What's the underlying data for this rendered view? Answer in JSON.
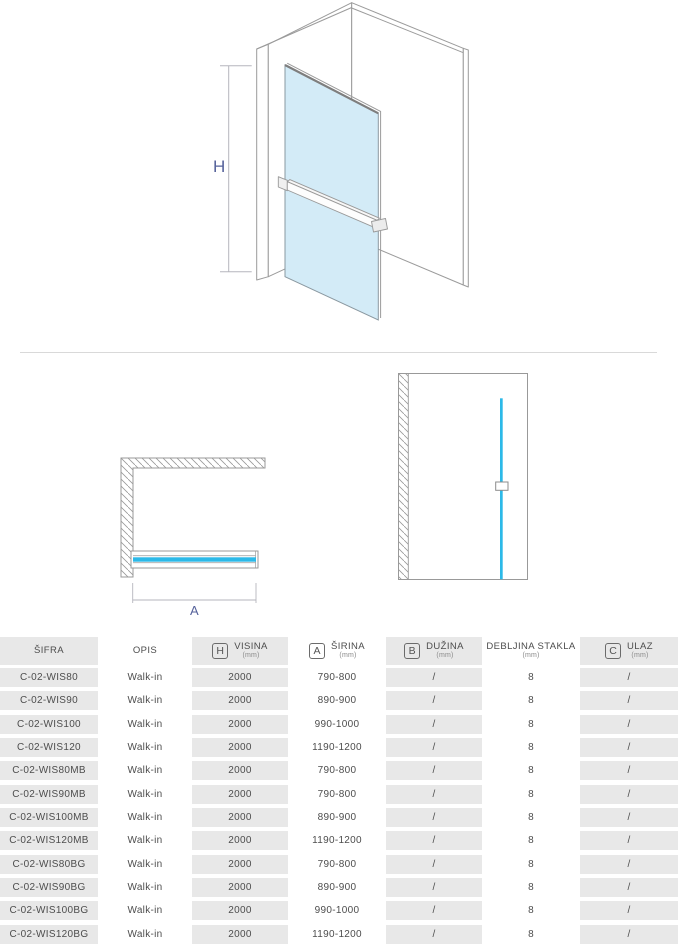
{
  "diagram": {
    "h_label": "H",
    "a_label": "A"
  },
  "colors": {
    "glass_fill": "#D3EBF7",
    "glass_edge_cyan": "#2CB9E8",
    "dimension_label": "#56629B",
    "line_gray": "#999999",
    "row_gray": "#E8E8E8"
  },
  "table": {
    "columns": [
      {
        "letter": "",
        "label": "ŠIFRA",
        "unit": ""
      },
      {
        "letter": "",
        "label": "OPIS",
        "unit": ""
      },
      {
        "letter": "H",
        "label": "VISINA",
        "unit": "(mm)"
      },
      {
        "letter": "A",
        "label": "ŠIRINA",
        "unit": "(mm)"
      },
      {
        "letter": "B",
        "label": "DUŽINA",
        "unit": "(mm)"
      },
      {
        "letter": "",
        "label": "DEBLJINA STAKLA",
        "unit": "(mm)"
      },
      {
        "letter": "C",
        "label": "ULAZ",
        "unit": "(mm)"
      }
    ],
    "rows": [
      [
        "C-02-WIS80",
        "Walk-in",
        "2000",
        "790-800",
        "/",
        "8",
        "/"
      ],
      [
        "C-02-WIS90",
        "Walk-in",
        "2000",
        "890-900",
        "/",
        "8",
        "/"
      ],
      [
        "C-02-WIS100",
        "Walk-in",
        "2000",
        "990-1000",
        "/",
        "8",
        "/"
      ],
      [
        "C-02-WIS120",
        "Walk-in",
        "2000",
        "1190-1200",
        "/",
        "8",
        "/"
      ],
      [
        "C-02-WIS80MB",
        "Walk-in",
        "2000",
        "790-800",
        "/",
        "8",
        "/"
      ],
      [
        "C-02-WIS90MB",
        "Walk-in",
        "2000",
        "790-800",
        "/",
        "8",
        "/"
      ],
      [
        "C-02-WIS100MB",
        "Walk-in",
        "2000",
        "890-900",
        "/",
        "8",
        "/"
      ],
      [
        "C-02-WIS120MB",
        "Walk-in",
        "2000",
        "1190-1200",
        "/",
        "8",
        "/"
      ],
      [
        "C-02-WIS80BG",
        "Walk-in",
        "2000",
        "790-800",
        "/",
        "8",
        "/"
      ],
      [
        "C-02-WIS90BG",
        "Walk-in",
        "2000",
        "890-900",
        "/",
        "8",
        "/"
      ],
      [
        "C-02-WIS100BG",
        "Walk-in",
        "2000",
        "990-1000",
        "/",
        "8",
        "/"
      ],
      [
        "C-02-WIS120BG",
        "Walk-in",
        "2000",
        "1190-1200",
        "/",
        "8",
        "/"
      ]
    ]
  }
}
